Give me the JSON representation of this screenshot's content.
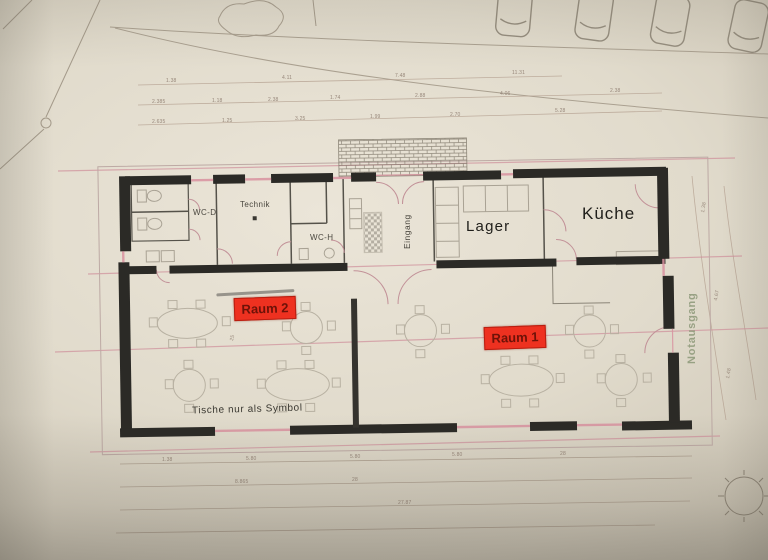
{
  "photo": {
    "description": "Photograph of an architectural floor plan on beige paper"
  },
  "rooms": {
    "wc_d": "WC-D",
    "technik": "Technik",
    "wc_h": "WC-H",
    "eingang": "Eingang",
    "lager": "Lager",
    "kueche": "Küche"
  },
  "highlights": {
    "raum2": "Raum 2",
    "raum1": "Raum 1"
  },
  "annotations": {
    "tables_note": "Tische nur als Symbol",
    "emergency_exit": "Notausgang"
  },
  "colors": {
    "highlight_red": "#ee3120",
    "wall_black": "#2b2a26",
    "plan_pink": "#cf8f9b",
    "exit_green": "#8c9878",
    "paper_beige": "#e5dfd2"
  },
  "dimensions": {
    "labels": [
      {
        "t": "1.38",
        "x": 166,
        "y": 78
      },
      {
        "t": "4.11",
        "x": 282,
        "y": 75
      },
      {
        "t": "7.48",
        "x": 395,
        "y": 73
      },
      {
        "t": "11.31",
        "x": 512,
        "y": 70
      },
      {
        "t": "2.385",
        "x": 152,
        "y": 99
      },
      {
        "t": "1.18",
        "x": 212,
        "y": 98
      },
      {
        "t": "2.38",
        "x": 268,
        "y": 97
      },
      {
        "t": "1.74",
        "x": 330,
        "y": 95
      },
      {
        "t": "2.88",
        "x": 415,
        "y": 93
      },
      {
        "t": "4.06",
        "x": 500,
        "y": 91
      },
      {
        "t": "2.38",
        "x": 610,
        "y": 88
      },
      {
        "t": "2.635",
        "x": 152,
        "y": 119
      },
      {
        "t": "1.25",
        "x": 222,
        "y": 118
      },
      {
        "t": "3.25",
        "x": 295,
        "y": 116
      },
      {
        "t": "1.99",
        "x": 370,
        "y": 114
      },
      {
        "t": "2.70",
        "x": 450,
        "y": 112
      },
      {
        "t": "5.28",
        "x": 555,
        "y": 108
      },
      {
        "t": "1.38",
        "x": 162,
        "y": 457
      },
      {
        "t": "5.80",
        "x": 246,
        "y": 456
      },
      {
        "t": "5.80",
        "x": 350,
        "y": 454
      },
      {
        "t": "5.80",
        "x": 452,
        "y": 452
      },
      {
        "t": "28",
        "x": 560,
        "y": 451
      },
      {
        "t": "8.865",
        "x": 235,
        "y": 479
      },
      {
        "t": "28",
        "x": 352,
        "y": 477
      },
      {
        "t": "27.87",
        "x": 398,
        "y": 500
      },
      {
        "t": "1.38",
        "x": 700,
        "y": 212,
        "r": -80
      },
      {
        "t": "4.67",
        "x": 713,
        "y": 300,
        "r": -80
      },
      {
        "t": "1.48",
        "x": 725,
        "y": 378,
        "r": -80
      },
      {
        "t": "25",
        "x": 229,
        "y": 340,
        "r": -75
      }
    ]
  }
}
